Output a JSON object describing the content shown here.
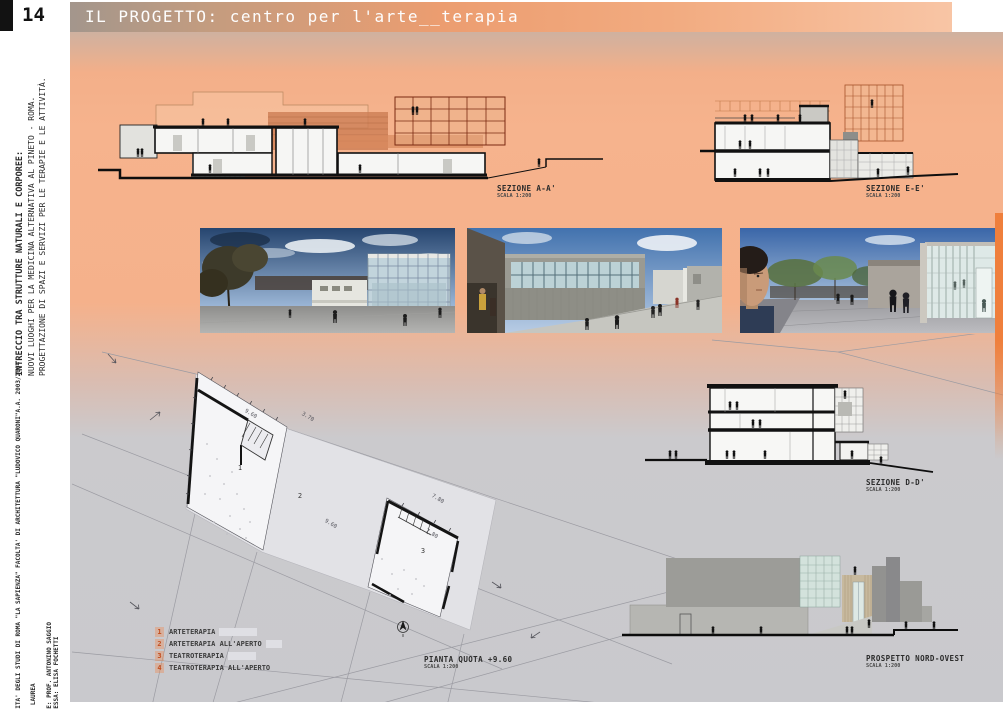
{
  "page": {
    "number": "14",
    "title": "IL PROGETTO: centro per l'arte__terapia"
  },
  "sidebar": {
    "project_title": "INTRECCIO TRA STRUTTURE NATURALI E CORPOREE:",
    "project_subtitle1": "NUOVI LUOGHI PER LA MEDICINA ALTERNATIVA AL PINETO - ROMA.",
    "project_subtitle2": "PROGETTAZIONE DI SPAZI E SERVIZI PER LE TERAPIE E LE ATTIVITÀ.",
    "university": "UNIVERSITA' DEGLI STUDI DI ROMA \"LA SAPIENZA\" FACOLTA' DI ARCHITETTURA \"LUDOVICO QUARONI\"",
    "academic_year": "A.A. 2003/2004",
    "thesis_type": "TESI DI LAUREA",
    "advisor": "RELATORE: PROF. ANTONINO SAGGIO",
    "student": "STUDENTESSA: ELISA FOCHETTI"
  },
  "drawings": {
    "section_aa": {
      "label": "SEZIONE A-A'",
      "scale": "SCALA 1:200"
    },
    "section_ee": {
      "label": "SEZIONE E-E'",
      "scale": "SCALA 1:200"
    },
    "section_dd": {
      "label": "SEZIONE D-D'",
      "scale": "SCALA 1:200"
    },
    "plan": {
      "label": "PIANTA QUOTA +9.60",
      "scale": "SCALA 1:200"
    },
    "elevation_nw": {
      "label": "PROSPETTO NORD-OVEST",
      "scale": "SCALA 1:200"
    }
  },
  "plan_annotations": {
    "room_1": "1",
    "room_2": "2",
    "room_3": "3",
    "dim_1": "9.60",
    "dim_2": "3.70",
    "dim_3": "9.60",
    "dim_4": "7.80",
    "dim_5": "7.80"
  },
  "legend": {
    "items": [
      {
        "number": "1",
        "label": "ARTETERAPIA"
      },
      {
        "number": "2",
        "label": "ARTETERAPIA ALL'APERTO"
      },
      {
        "number": "3",
        "label": "TEATROTERAPIA"
      },
      {
        "number": "4",
        "label": "TEATROTERAPIA ALL'APERTO"
      }
    ]
  },
  "colors": {
    "accent_orange": "#ef7f3c",
    "peach_background": "#f5b18b",
    "gray_background": "#c9c9cd",
    "header_gradient_left": "#a3968c",
    "header_gradient_right": "#f8c5a5"
  }
}
